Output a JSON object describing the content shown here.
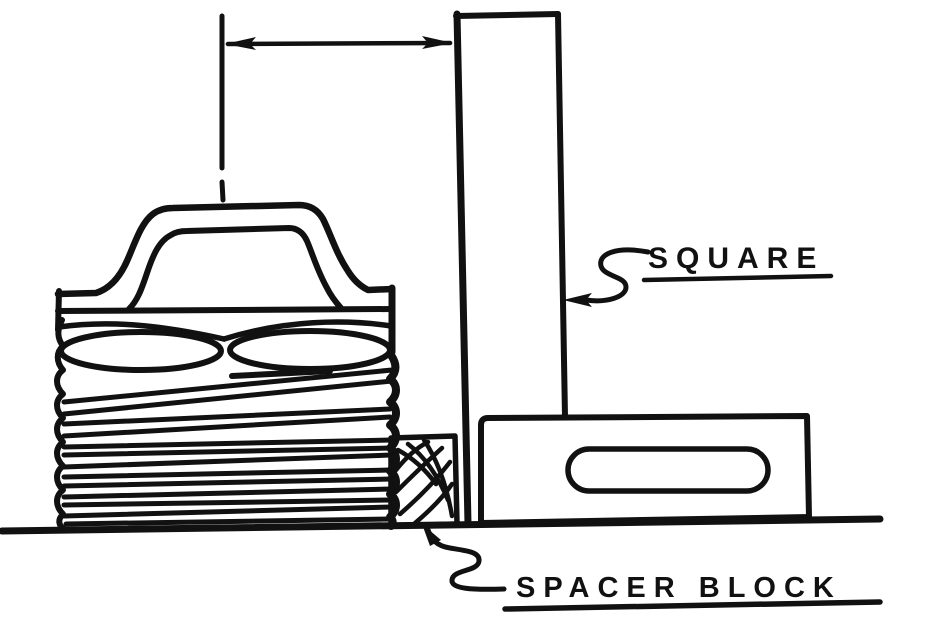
{
  "figure": {
    "kind": "technical-line-drawing",
    "description_parts": [
      "coil-spring-with-loop-top",
      "machinist-square",
      "spacer-block",
      "surface-line",
      "width-dimension"
    ],
    "labels": {
      "square": "SQUARE",
      "spacer_block": "SPACER BLOCK"
    },
    "colors": {
      "ink": "#111111",
      "paper": "#ffffff"
    }
  }
}
